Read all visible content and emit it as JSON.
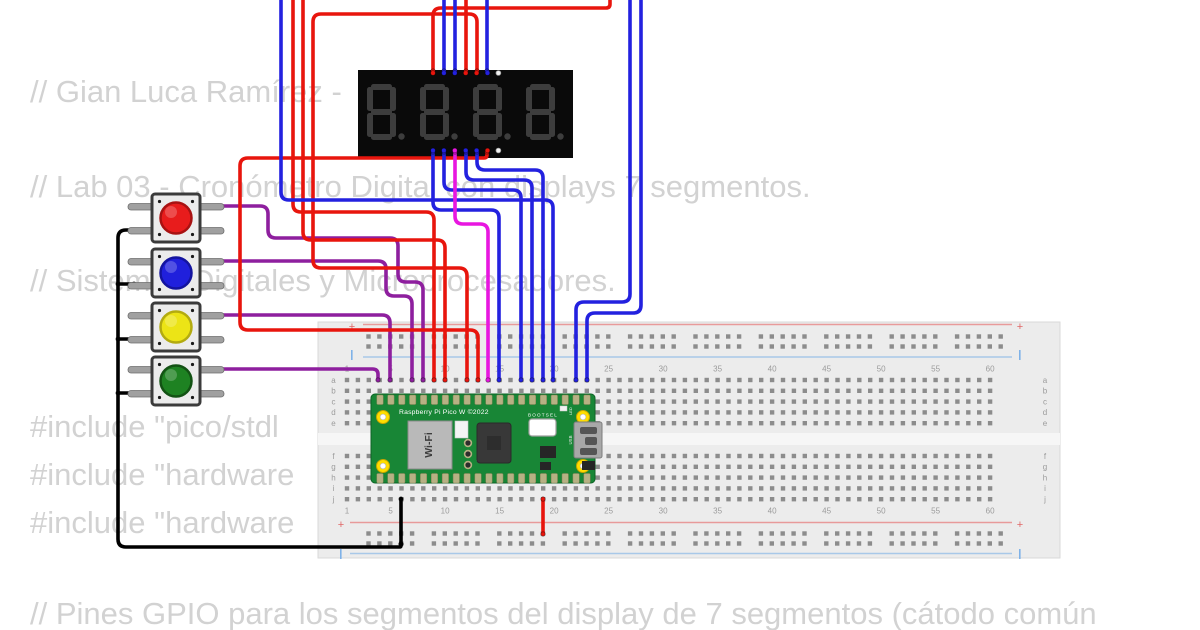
{
  "scene": {
    "width": 1200,
    "height": 630,
    "background": "#ffffff"
  },
  "background_code": {
    "color": "#d2d2d2",
    "lines": [
      {
        "text": "// Gian Luca Ramírez -",
        "top": 74
      },
      {
        "text": "// Lab 03 - Cronómetro Digital con displays 7 segmentos.",
        "top": 169
      },
      {
        "text": "// Sistemas Digitales y Microprocesadores.",
        "top": 263
      },
      {
        "text": "#include \"pico/stdl",
        "top": 409
      },
      {
        "text": "#include \"hardware",
        "top": 457
      },
      {
        "text": "#include \"hardware",
        "top": 505
      },
      {
        "text": "// Pines GPIO para los segmentos del display de 7 segmentos (cátodo común",
        "top": 596
      }
    ]
  },
  "display": {
    "x": 358,
    "y": 70,
    "w": 215,
    "h": 88,
    "bg": "#0a0a0a",
    "segment_color": "#3d3d3d",
    "digit_count": 4,
    "top_pins": [
      "#e8150d",
      "#2321df",
      "#2321df",
      "#e8150d",
      "#e8150d",
      "#2321df",
      "#f2f2f2"
    ],
    "bottom_pins": [
      "#2321df",
      "#2321df",
      "#e816e0",
      "#2321df",
      "#2321df",
      "#e8150d",
      "#f2f2f2"
    ],
    "unconnected_pin_stroke": "#999999"
  },
  "buttons": [
    {
      "name": "red",
      "cap": "#e81c1c",
      "ring": "#a81212",
      "x": 152,
      "y": 194
    },
    {
      "name": "blue",
      "cap": "#2020dc",
      "ring": "#14149e",
      "x": 152,
      "y": 249
    },
    {
      "name": "yellow",
      "cap": "#ece416",
      "ring": "#b3ab10",
      "x": 152,
      "y": 303
    },
    {
      "name": "green",
      "cap": "#1e8222",
      "ring": "#135214",
      "x": 152,
      "y": 357
    }
  ],
  "breadboard": {
    "x": 318,
    "y": 322,
    "w": 742,
    "h": 236,
    "body_color": "#ececec",
    "divider_color": "#f6f6f6",
    "hole_color": "#8c8c8c",
    "label_color": "#9b9b9b",
    "rail_red": "#e89a9a",
    "rail_blue": "#a8c8e8",
    "plus_label": "+",
    "column_numbers": [
      1,
      5,
      10,
      15,
      20,
      25,
      30,
      35,
      40,
      45,
      50,
      55,
      60
    ],
    "row_letters_top": [
      "a",
      "b",
      "c",
      "d",
      "e"
    ],
    "row_letters_bottom": [
      "f",
      "g",
      "h",
      "i",
      "j"
    ]
  },
  "pico": {
    "board_color": "#188636",
    "board_edge": "#0e6325",
    "pad_color": "#b7b184",
    "pad_edge": "#8a8457",
    "title": "Raspberry Pi Pico W ©2022",
    "wifi_label": "Wi-Fi",
    "bootsel_label": "BOOTSEL",
    "debug_label": "DEBUG",
    "usb_label": "USB",
    "led_label": "LED"
  },
  "wire_colors": {
    "black": "#000000",
    "purple": "#8e1f9e",
    "red": "#e8150d",
    "blue": "#2321df",
    "magenta": "#e816e0"
  },
  "wires": [
    {
      "name": "gnd-buttons-trunk",
      "color": "#000000",
      "points": [
        [
          134,
          230
        ],
        [
          118,
          230
        ],
        [
          118,
          547
        ],
        [
          401,
          547
        ],
        [
          401,
          544
        ]
      ]
    },
    {
      "name": "gnd-stub-btn-blue",
      "color": "#000000",
      "points": [
        [
          134,
          284
        ],
        [
          118,
          284
        ]
      ]
    },
    {
      "name": "gnd-stub-btn-yellow",
      "color": "#000000",
      "points": [
        [
          134,
          339
        ],
        [
          118,
          339
        ]
      ]
    },
    {
      "name": "gnd-stub-btn-green",
      "color": "#000000",
      "points": [
        [
          134,
          393
        ],
        [
          118,
          393
        ]
      ]
    },
    {
      "name": "gnd-pico-jumper",
      "color": "#000000",
      "points": [
        [
          401,
          499
        ],
        [
          401,
          544
        ]
      ]
    },
    {
      "name": "btn-red-signal",
      "color": "#8e1f9e",
      "points": [
        [
          218,
          206
        ],
        [
          268,
          206
        ],
        [
          268,
          238
        ],
        [
          398,
          238
        ],
        [
          398,
          282
        ],
        [
          423,
          282
        ],
        [
          423,
          380
        ]
      ]
    },
    {
      "name": "btn-blue-signal",
      "color": "#8e1f9e",
      "points": [
        [
          218,
          261
        ],
        [
          386,
          261
        ],
        [
          386,
          296
        ],
        [
          412,
          296
        ],
        [
          412,
          380
        ]
      ]
    },
    {
      "name": "btn-yellow-signal",
      "color": "#8e1f9e",
      "points": [
        [
          218,
          315
        ],
        [
          390,
          315
        ],
        [
          390,
          380
        ]
      ]
    },
    {
      "name": "btn-green-signal",
      "color": "#8e1f9e",
      "points": [
        [
          218,
          369
        ],
        [
          378,
          369
        ],
        [
          378,
          380
        ]
      ]
    },
    {
      "name": "red-from-top-1",
      "color": "#e8150d",
      "points": [
        [
          293,
          0
        ],
        [
          293,
          212
        ],
        [
          434,
          212
        ],
        [
          434,
          380
        ]
      ]
    },
    {
      "name": "red-from-top-2",
      "color": "#e8150d",
      "points": [
        [
          303,
          0
        ],
        [
          303,
          240
        ],
        [
          445,
          240
        ],
        [
          445,
          380
        ]
      ]
    },
    {
      "name": "display-top-red-loop",
      "color": "#e8150d",
      "points": [
        [
          477,
          71
        ],
        [
          477,
          14
        ],
        [
          313,
          14
        ],
        [
          313,
          268
        ],
        [
          467,
          268
        ],
        [
          467,
          380
        ]
      ]
    },
    {
      "name": "display-bottom-red",
      "color": "#e8150d",
      "points": [
        [
          487,
          152
        ],
        [
          487,
          158
        ],
        [
          240,
          158
        ],
        [
          240,
          330
        ],
        [
          478,
          330
        ],
        [
          478,
          380
        ]
      ]
    },
    {
      "name": "display-top-red-up",
      "color": "#e8150d",
      "points": [
        [
          433,
          71
        ],
        [
          433,
          8
        ],
        [
          610,
          8
        ],
        [
          610,
          0
        ]
      ]
    },
    {
      "name": "display-top-red-b",
      "color": "#e8150d",
      "points": [
        [
          466,
          71
        ],
        [
          466,
          0
        ]
      ]
    },
    {
      "name": "pico-5v-rail",
      "color": "#e8150d",
      "points": [
        [
          543,
          499
        ],
        [
          543,
          534
        ]
      ]
    },
    {
      "name": "display-top-blue-1",
      "color": "#2321df",
      "points": [
        [
          444,
          71
        ],
        [
          444,
          0
        ]
      ]
    },
    {
      "name": "display-top-blue-2",
      "color": "#2321df",
      "points": [
        [
          455,
          71
        ],
        [
          455,
          0
        ]
      ]
    },
    {
      "name": "display-top-blue-3",
      "color": "#2321df",
      "points": [
        [
          487,
          71
        ],
        [
          487,
          0
        ]
      ]
    },
    {
      "name": "display-bottom-blue-1",
      "color": "#2321df",
      "points": [
        [
          433,
          152
        ],
        [
          433,
          210
        ],
        [
          499,
          210
        ],
        [
          499,
          380
        ]
      ]
    },
    {
      "name": "display-bottom-blue-2",
      "color": "#2321df",
      "points": [
        [
          444,
          152
        ],
        [
          444,
          190
        ],
        [
          521,
          190
        ],
        [
          521,
          380
        ]
      ]
    },
    {
      "name": "display-bottom-blue-3",
      "color": "#2321df",
      "points": [
        [
          466,
          152
        ],
        [
          466,
          180
        ],
        [
          532,
          180
        ],
        [
          532,
          380
        ]
      ]
    },
    {
      "name": "display-bottom-blue-4",
      "color": "#2321df",
      "points": [
        [
          477,
          152
        ],
        [
          477,
          170
        ],
        [
          543,
          170
        ],
        [
          543,
          380
        ]
      ]
    },
    {
      "name": "blue-from-top",
      "color": "#2321df",
      "points": [
        [
          281,
          0
        ],
        [
          281,
          200
        ],
        [
          553,
          200
        ],
        [
          553,
          380
        ]
      ]
    },
    {
      "name": "blue-right-1",
      "color": "#2321df",
      "points": [
        [
          630,
          0
        ],
        [
          630,
          302
        ],
        [
          576,
          302
        ],
        [
          576,
          380
        ]
      ]
    },
    {
      "name": "blue-right-2",
      "color": "#2321df",
      "points": [
        [
          641,
          0
        ],
        [
          641,
          313
        ],
        [
          587,
          313
        ],
        [
          587,
          380
        ]
      ]
    },
    {
      "name": "display-bottom-magenta",
      "color": "#e816e0",
      "points": [
        [
          455,
          152
        ],
        [
          455,
          224
        ],
        [
          488,
          224
        ],
        [
          488,
          380
        ]
      ]
    }
  ]
}
